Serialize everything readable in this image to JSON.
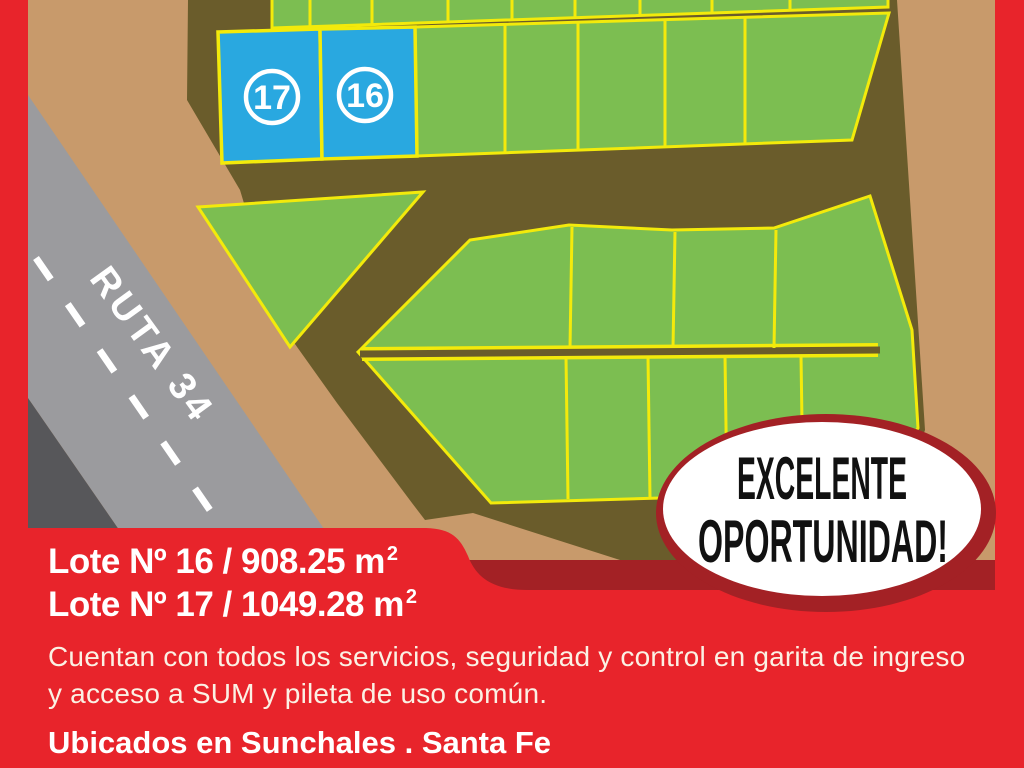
{
  "palette": {
    "frame_red": "#E8242B",
    "dark_red_shadow": "#A32125",
    "terrain_tan": "#C89A6B",
    "street_brown": "#6A5C2B",
    "lot_green": "#7CBE51",
    "lot_border_yellow": "#F3EA0B",
    "highlight_blue": "#29A8E0",
    "road_gray": "#9B9B9E",
    "road_dark_gray": "#57575A",
    "text_white": "#FFFFFF"
  },
  "map": {
    "road": {
      "label": "RUTA 34"
    },
    "highlighted_lots": [
      {
        "number": "17"
      },
      {
        "number": "16"
      }
    ]
  },
  "badge": {
    "line1": "EXCELENTE",
    "line2": "OPORTUNIDAD!"
  },
  "details": {
    "lot16_line": "Lote Nº 16 / 908.25 m",
    "lot16_sup": "2",
    "lot17_line": "Lote Nº 17 / 1049.28 m",
    "lot17_sup": "2",
    "description_line1": "Cuentan con todos los servicios, seguridad y control en garita de ingreso",
    "description_line2": "y acceso a SUM y pileta de uso común.",
    "location": "Ubicados en Sunchales . Santa Fe"
  }
}
